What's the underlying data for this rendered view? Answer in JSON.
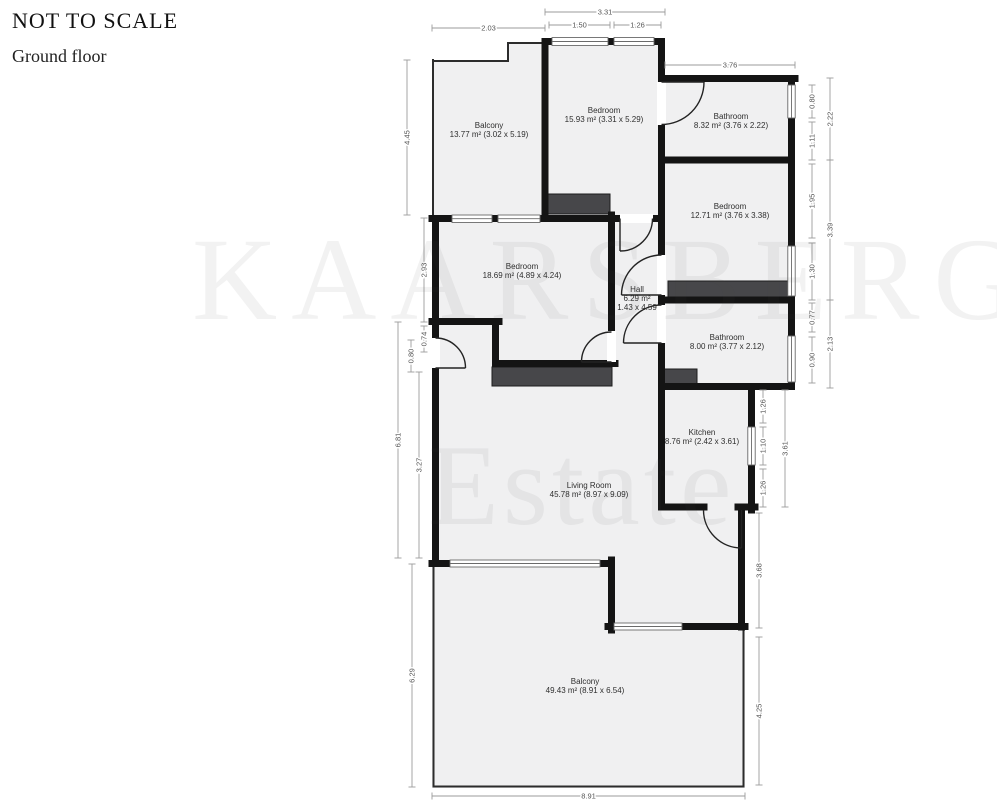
{
  "header": {
    "not_to_scale": "NOT TO SCALE",
    "floor": "Ground floor"
  },
  "watermark": {
    "line1": "KAARSBERG",
    "line2": "Estate"
  },
  "floorplan": {
    "rooms": [
      {
        "id": "balcony-top",
        "cx": 489,
        "cy": 128,
        "lines": [
          "Balcony",
          "13.77 m² (3.02 x 5.19)"
        ]
      },
      {
        "id": "bedroom-top",
        "cx": 604,
        "cy": 113,
        "lines": [
          "Bedroom",
          "15.93 m² (3.31 x 5.29)"
        ]
      },
      {
        "id": "bathroom-top-right",
        "cx": 731,
        "cy": 119,
        "lines": [
          "Bathroom",
          "8.32 m² (3.76 x 2.22)"
        ]
      },
      {
        "id": "bedroom-right",
        "cx": 730,
        "cy": 209,
        "lines": [
          "Bedroom",
          "12.71 m² (3.76 x 3.38)"
        ]
      },
      {
        "id": "bedroom-left",
        "cx": 522,
        "cy": 269,
        "lines": [
          "Bedroom",
          "18.69 m² (4.89 x 4.24)"
        ]
      },
      {
        "id": "hall",
        "cx": 637,
        "cy": 292,
        "lines": [
          "Hall",
          "6.29 m²",
          "1.43 x 4.59"
        ]
      },
      {
        "id": "bathroom-middle",
        "cx": 727,
        "cy": 340,
        "lines": [
          "Bathroom",
          "8.00 m² (3.77 x 2.12)"
        ]
      },
      {
        "id": "kitchen",
        "cx": 702,
        "cy": 435,
        "lines": [
          "Kitchen",
          "8.76 m² (2.42 x 3.61)"
        ]
      },
      {
        "id": "living-room",
        "cx": 589,
        "cy": 488,
        "lines": [
          "Living Room",
          "45.78 m² (8.97 x 9.09)"
        ]
      },
      {
        "id": "balcony-bottom",
        "cx": 585,
        "cy": 684,
        "lines": [
          "Balcony",
          "49.43 m² (8.91 x 6.54)"
        ]
      }
    ],
    "dimensions": [
      {
        "label": "2.03",
        "x1": 432,
        "x2": 545,
        "y": 28
      },
      {
        "label": "3.31",
        "x1": 545,
        "x2": 665,
        "y": 12
      },
      {
        "label": "1.50",
        "x1": 549,
        "x2": 610,
        "y": 25
      },
      {
        "label": "1.26",
        "x1": 614,
        "x2": 661,
        "y": 25
      },
      {
        "label": "3.76",
        "x1": 665,
        "x2": 795,
        "y": 65
      },
      {
        "label": "8.91",
        "x1": 432,
        "x2": 745,
        "y": 796
      },
      {
        "label": "4.45",
        "x": 407,
        "y1": 60,
        "y2": 215
      },
      {
        "label": "2.93",
        "x": 424,
        "y1": 218,
        "y2": 322
      },
      {
        "label": "0.74",
        "x": 424,
        "y1": 326,
        "y2": 352
      },
      {
        "label": "0.80",
        "x": 411,
        "y1": 340,
        "y2": 372
      },
      {
        "label": "6.81",
        "x": 398,
        "y1": 322,
        "y2": 558
      },
      {
        "label": "3.27",
        "x": 419,
        "y1": 372,
        "y2": 558
      },
      {
        "label": "6.29",
        "x": 412,
        "y1": 564,
        "y2": 787
      },
      {
        "label": "0.80",
        "x": 812,
        "y1": 85,
        "y2": 118
      },
      {
        "label": "2.22",
        "x": 830,
        "y1": 78,
        "y2": 160
      },
      {
        "label": "1.11",
        "x": 812,
        "y1": 122,
        "y2": 160
      },
      {
        "label": "1.95",
        "x": 812,
        "y1": 164,
        "y2": 238
      },
      {
        "label": "3.39",
        "x": 830,
        "y1": 160,
        "y2": 300
      },
      {
        "label": "1.30",
        "x": 812,
        "y1": 243,
        "y2": 300
      },
      {
        "label": "0.77",
        "x": 812,
        "y1": 303,
        "y2": 332
      },
      {
        "label": "2.13",
        "x": 830,
        "y1": 300,
        "y2": 388
      },
      {
        "label": "0.90",
        "x": 812,
        "y1": 337,
        "y2": 383
      },
      {
        "label": "1.26",
        "x": 763,
        "y1": 390,
        "y2": 423
      },
      {
        "label": "1.10",
        "x": 763,
        "y1": 427,
        "y2": 465
      },
      {
        "label": "1.26",
        "x": 763,
        "y1": 469,
        "y2": 507
      },
      {
        "label": "3.61",
        "x": 785,
        "y1": 390,
        "y2": 507
      },
      {
        "label": "3.68",
        "x": 759,
        "y1": 513,
        "y2": 628
      },
      {
        "label": "4.25",
        "x": 759,
        "y1": 637,
        "y2": 785
      }
    ]
  }
}
